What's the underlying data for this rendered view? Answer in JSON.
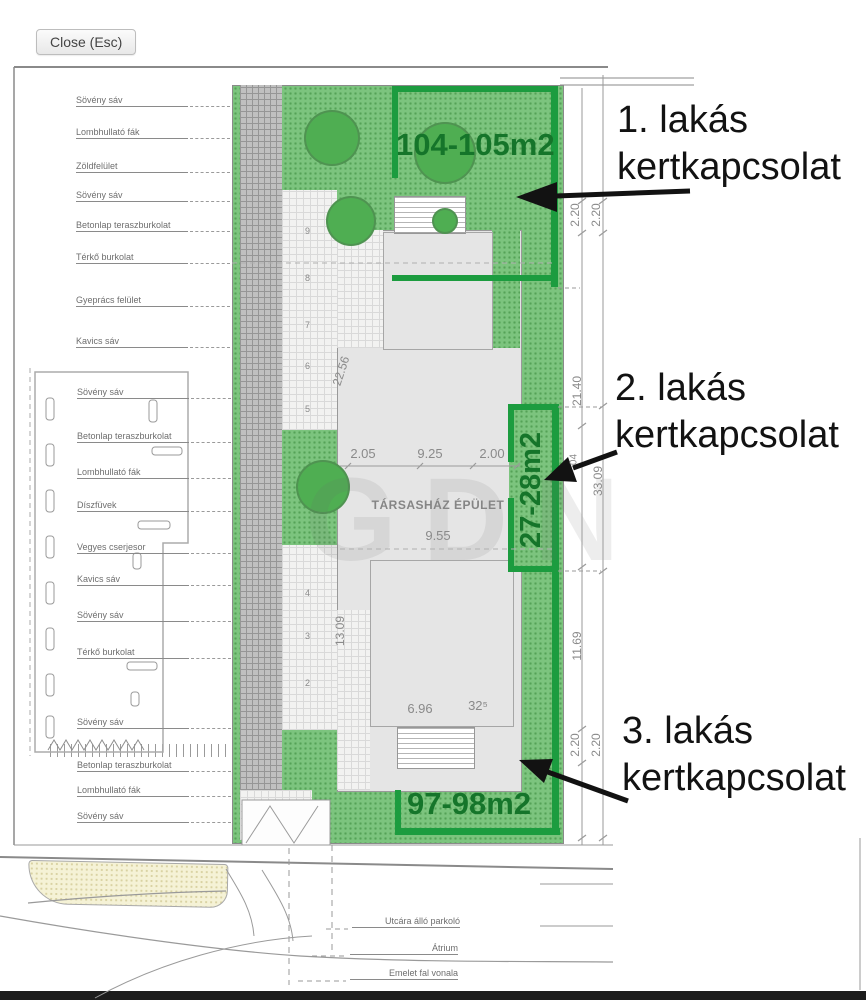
{
  "viewer": {
    "close_label": "Close (Esc)"
  },
  "legend_top": [
    "Sövény sáv",
    "Lombhullató fák",
    "Zöldfelület",
    "Sövény sáv",
    "Betonlap teraszburkolat",
    "Térkő burkolat",
    "Gyeprács felület",
    "Kavics sáv"
  ],
  "legend_bottom": [
    "Sövény sáv",
    "Betonlap teraszburkolat",
    "Lombhullató fák",
    "Díszfüvek",
    "Vegyes cserjesor",
    "Kavics sáv",
    "Sövény sáv",
    "Térkő burkolat",
    "Sövény sáv",
    "Betonlap teraszburkolat",
    "Lombhullató fák",
    "Sövény sáv"
  ],
  "apartments": [
    {
      "name": "1. lakás",
      "sub": "kertkapcsolat",
      "area": "104-105m2"
    },
    {
      "name": "2. lakás",
      "sub": "kertkapcsolat",
      "area": "27-28m2"
    },
    {
      "name": "3. lakás",
      "sub": "kertkapcsolat",
      "area": "97-98m2"
    }
  ],
  "building": {
    "label": "TÁRSASHÁZ ÉPÜLET",
    "width_dims": [
      "2.05",
      "9.25",
      "2.00"
    ],
    "ground_dim": "9.55",
    "lower_dims": [
      "6.96",
      "32⁵"
    ],
    "walk_dim_upper": "22.56",
    "walk_dim_lower": "13.09",
    "stairs_upper": [
      "9",
      "8",
      "7",
      "6",
      "5"
    ],
    "stairs_lower": [
      "4",
      "3",
      "2"
    ]
  },
  "site_dims": {
    "top": [
      "2.20",
      "2.20"
    ],
    "right_upper": "21.40",
    "right_total": "33.09",
    "right_small": "04",
    "right_lower": "11.69",
    "bottom": [
      "2.20",
      "2.20"
    ]
  },
  "road_labels": [
    "Utcára álló parkoló",
    "Átrium",
    "Emelet fal vonala"
  ],
  "watermark": "GDN",
  "colors": {
    "garden_border": "#1c9c3f",
    "garden_text": "#15752a",
    "site_green": "#7cc47e",
    "annotation_text": "#121212"
  }
}
